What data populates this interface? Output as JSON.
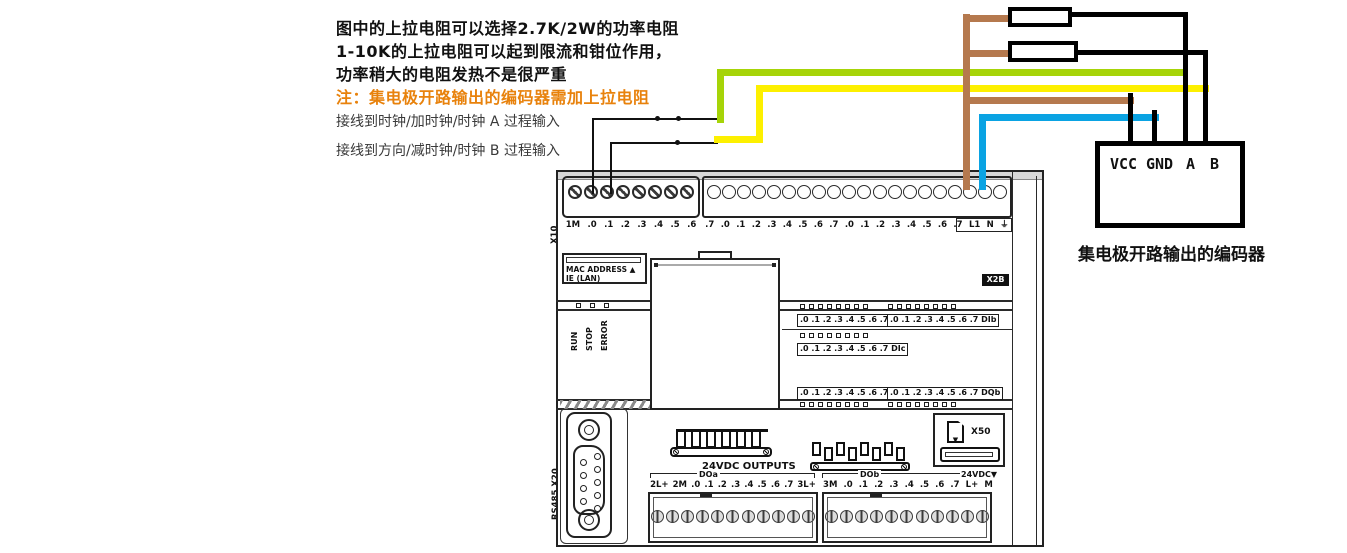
{
  "notes": {
    "line1": "图中的上拉电阻可以选择2.7K/2W的功率电阻",
    "line2": "1-10K的上拉电阻可以起到限流和钳位作用，",
    "line3": "功率稍大的电阻发热不是很严重",
    "warning": "注：集电极开路输出的编码器需加上拉电阻",
    "wire_a": "接线到时钟/加时钟/时钟 A 过程输入",
    "wire_b": "接线到方向/减时钟/时钟 B 过程输入"
  },
  "encoder": {
    "pins": [
      "VCC",
      "GND",
      "A",
      "B"
    ],
    "caption": "集电极开路输出的编码器"
  },
  "plc": {
    "model": "CPU ST40",
    "part_number": "288-1ST40-0AA0",
    "labels": {
      "x10": "X10",
      "x11": "X11",
      "x12": "◀X12",
      "x13": "◀X13",
      "x2b": "X2B",
      "x50": "X50",
      "x1p1": "X1 P1",
      "rs485": "RS485 X20",
      "link": "LINK",
      "rxtx": "Rx/Tx",
      "mac1": "MAC ADDRESS ▲",
      "mac2": "IE (LAN)"
    },
    "status_leds": [
      "RUN",
      "STOP",
      "ERROR"
    ],
    "top_terminals": {
      "block1": [
        "1M",
        ".0",
        ".1",
        ".2",
        ".3",
        ".4",
        ".5",
        ".6"
      ],
      "block2": [
        ".7",
        ".0",
        ".1",
        ".2",
        ".3",
        ".4",
        ".5",
        ".6",
        ".7",
        ".0",
        ".1",
        ".2",
        ".3",
        ".4",
        ".5",
        ".6",
        ".7",
        "L1",
        "N",
        "⏚"
      ],
      "group_a": "DIa",
      "group_b": "DIb",
      "group_c": "DIc",
      "inputs_label": "24VDC INPUTS",
      "supply_arrow": "▼",
      "supply_label": "24VDC"
    },
    "io_leds": {
      "dia": ".0 .1 .2 .3 .4 .5 .6 .7 DIa",
      "dib": ".0 .1 .2 .3 .4 .5 .6 .7 DIb",
      "dic": ".0 .1 .2 .3 .4 .5 .6 .7 DIc",
      "dqa": ".0 .1 .2 .3 .4 .5 .6 .7 DQa",
      "dqb": ".0 .1 .2 .3 .4 .5 .6 .7 DQb"
    },
    "bottom_terminals": {
      "outputs_label": "24VDC OUTPUTS",
      "group_a": "DOa",
      "group_b": "DOb",
      "left": [
        "2L+",
        "2M",
        ".0",
        ".1",
        ".2",
        ".3",
        ".4",
        ".5",
        ".6",
        ".7",
        "3L+"
      ],
      "right": [
        "3M",
        ".0",
        ".1",
        ".2",
        ".3",
        ".4",
        ".5",
        ".6",
        ".7",
        "L+",
        "M"
      ],
      "supply_label": "24VDC▼"
    }
  },
  "colors": {
    "wire_a_green": "#a6d408",
    "wire_b_yellow": "#fdf000",
    "wire_vcc_brown": "#b5794e",
    "wire_gnd_blue": "#0aa3e3",
    "wire_black": "#111111",
    "warning_orange": "#e8820c"
  }
}
